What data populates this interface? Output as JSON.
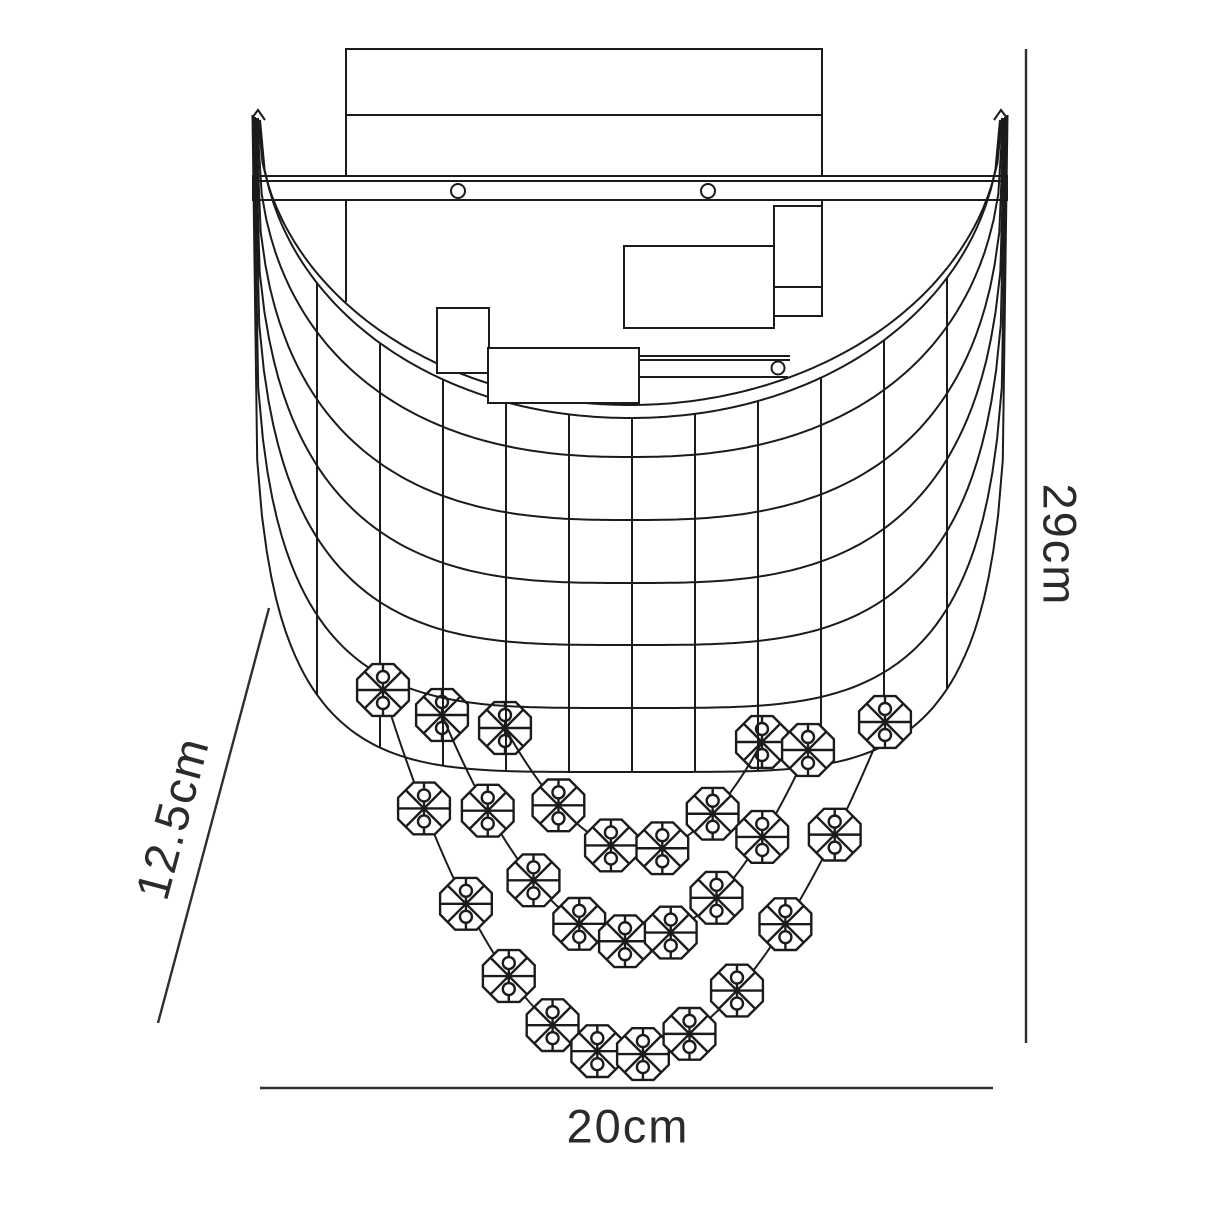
{
  "page": {
    "background": "#ffffff"
  },
  "dimensions": {
    "height": {
      "label": "29cm"
    },
    "width": {
      "label": "20cm"
    },
    "depth": {
      "label": "12.5cm"
    }
  },
  "diagram": {
    "canvas": [
      1214,
      1214
    ],
    "stroke": "#1b1b1b",
    "dim_stroke": "#2e2e36",
    "bead_fill": "#ffffff",
    "shade": {
      "cx": 630,
      "curves": [
        {
          "top": 118,
          "a": 372.0,
          "bottom": 405,
          "n": 2.0
        },
        {
          "top": 120,
          "a": 370.0,
          "bottom": 418,
          "n": 2.05
        },
        {
          "top": 119,
          "a": 373.0,
          "bottom": 457,
          "n": 2.35
        },
        {
          "top": 118,
          "a": 374.0,
          "bottom": 520,
          "n": 2.7
        },
        {
          "top": 117,
          "a": 375.0,
          "bottom": 583,
          "n": 3.0
        },
        {
          "top": 117,
          "a": 375.5,
          "bottom": 645,
          "n": 3.4
        },
        {
          "top": 116,
          "a": 376.5,
          "bottom": 708,
          "n": 3.9
        },
        {
          "top": 115,
          "a": 377.5,
          "bottom": 772,
          "n": 4.5
        }
      ],
      "rim_index": 1,
      "outer_index": 7,
      "vertical_xs": [
        317,
        380,
        443,
        506,
        569,
        632,
        695,
        758,
        821,
        884,
        947
      ],
      "tip_caps": [
        "M 252,118 L 258,110 L 265,120",
        "M 1007,118 L 1001,110 L 994,120"
      ]
    },
    "internals": {
      "backplate": {
        "x": 346,
        "y": 49,
        "w": 476,
        "h": 127
      },
      "backplate_divider": {
        "x1": 346,
        "y1": 115,
        "x2": 822,
        "y2": 115
      },
      "side_edges": [
        {
          "x1": 346,
          "y1": 200,
          "x2": 346,
          "y2": 302
        },
        {
          "x1": 822,
          "y1": 200,
          "x2": 822,
          "y2": 316
        }
      ],
      "bracket_top": {
        "rect": {
          "x": 253,
          "y": 176,
          "w": 754,
          "h": 24
        },
        "inner_line": {
          "x1": 253,
          "y1": 181,
          "x2": 1007,
          "y2": 181
        },
        "screws": [
          {
            "cx": 458,
            "cy": 191,
            "r": 7
          },
          {
            "cx": 708,
            "cy": 191,
            "r": 7
          }
        ]
      },
      "bracket_low": {
        "lines": [
          {
            "x1": 639,
            "y1": 356,
            "x2": 790,
            "y2": 356
          },
          {
            "x1": 639,
            "y1": 360,
            "x2": 790,
            "y2": 360
          },
          {
            "x1": 639,
            "y1": 377,
            "x2": 788,
            "y2": 377
          }
        ],
        "screws": [
          {
            "cx": 778,
            "cy": 368,
            "r": 6.5
          }
        ]
      },
      "boxes": [
        {
          "x": 774,
          "y": 206,
          "w": 48,
          "h": 81
        },
        {
          "x": 774,
          "y": 287,
          "w": 48,
          "h": 29
        }
      ]
    },
    "white_rects": [
      {
        "x": 437,
        "y": 308,
        "w": 52,
        "h": 65
      },
      {
        "x": 488,
        "y": 348,
        "w": 151,
        "h": 55
      },
      {
        "x": 624,
        "y": 246,
        "w": 150,
        "h": 82
      }
    ],
    "strands": [
      {
        "p0": [
          505,
          728
        ],
        "c": [
          640,
          968
        ],
        "p2": [
          762,
          742
        ],
        "beads": 6,
        "behind": [
          0,
          5
        ]
      },
      {
        "p0": [
          442,
          715
        ],
        "c": [
          625,
          1150
        ],
        "p2": [
          808,
          750
        ],
        "beads": 9,
        "behind": [
          0
        ]
      },
      {
        "p0": [
          383,
          690
        ],
        "c": [
          606,
          1405
        ],
        "p2": [
          885,
          722
        ],
        "beads": 12,
        "behind": []
      }
    ],
    "bead": {
      "r": 28,
      "link_r": 6,
      "link_off": 13
    },
    "dim_lines": {
      "height": {
        "x": 1026,
        "y1": 49,
        "y2": 1043,
        "label_x": 1060,
        "label_y": 545,
        "angle": 90
      },
      "width": {
        "y": 1088,
        "x1": 260,
        "x2": 993,
        "label_x": 628,
        "label_y": 1126,
        "angle": 0
      },
      "depth": {
        "x1": 269,
        "y1": 608,
        "x2": 158,
        "y2": 1023,
        "label_x": 172,
        "label_y": 818,
        "angle": -75
      }
    }
  }
}
